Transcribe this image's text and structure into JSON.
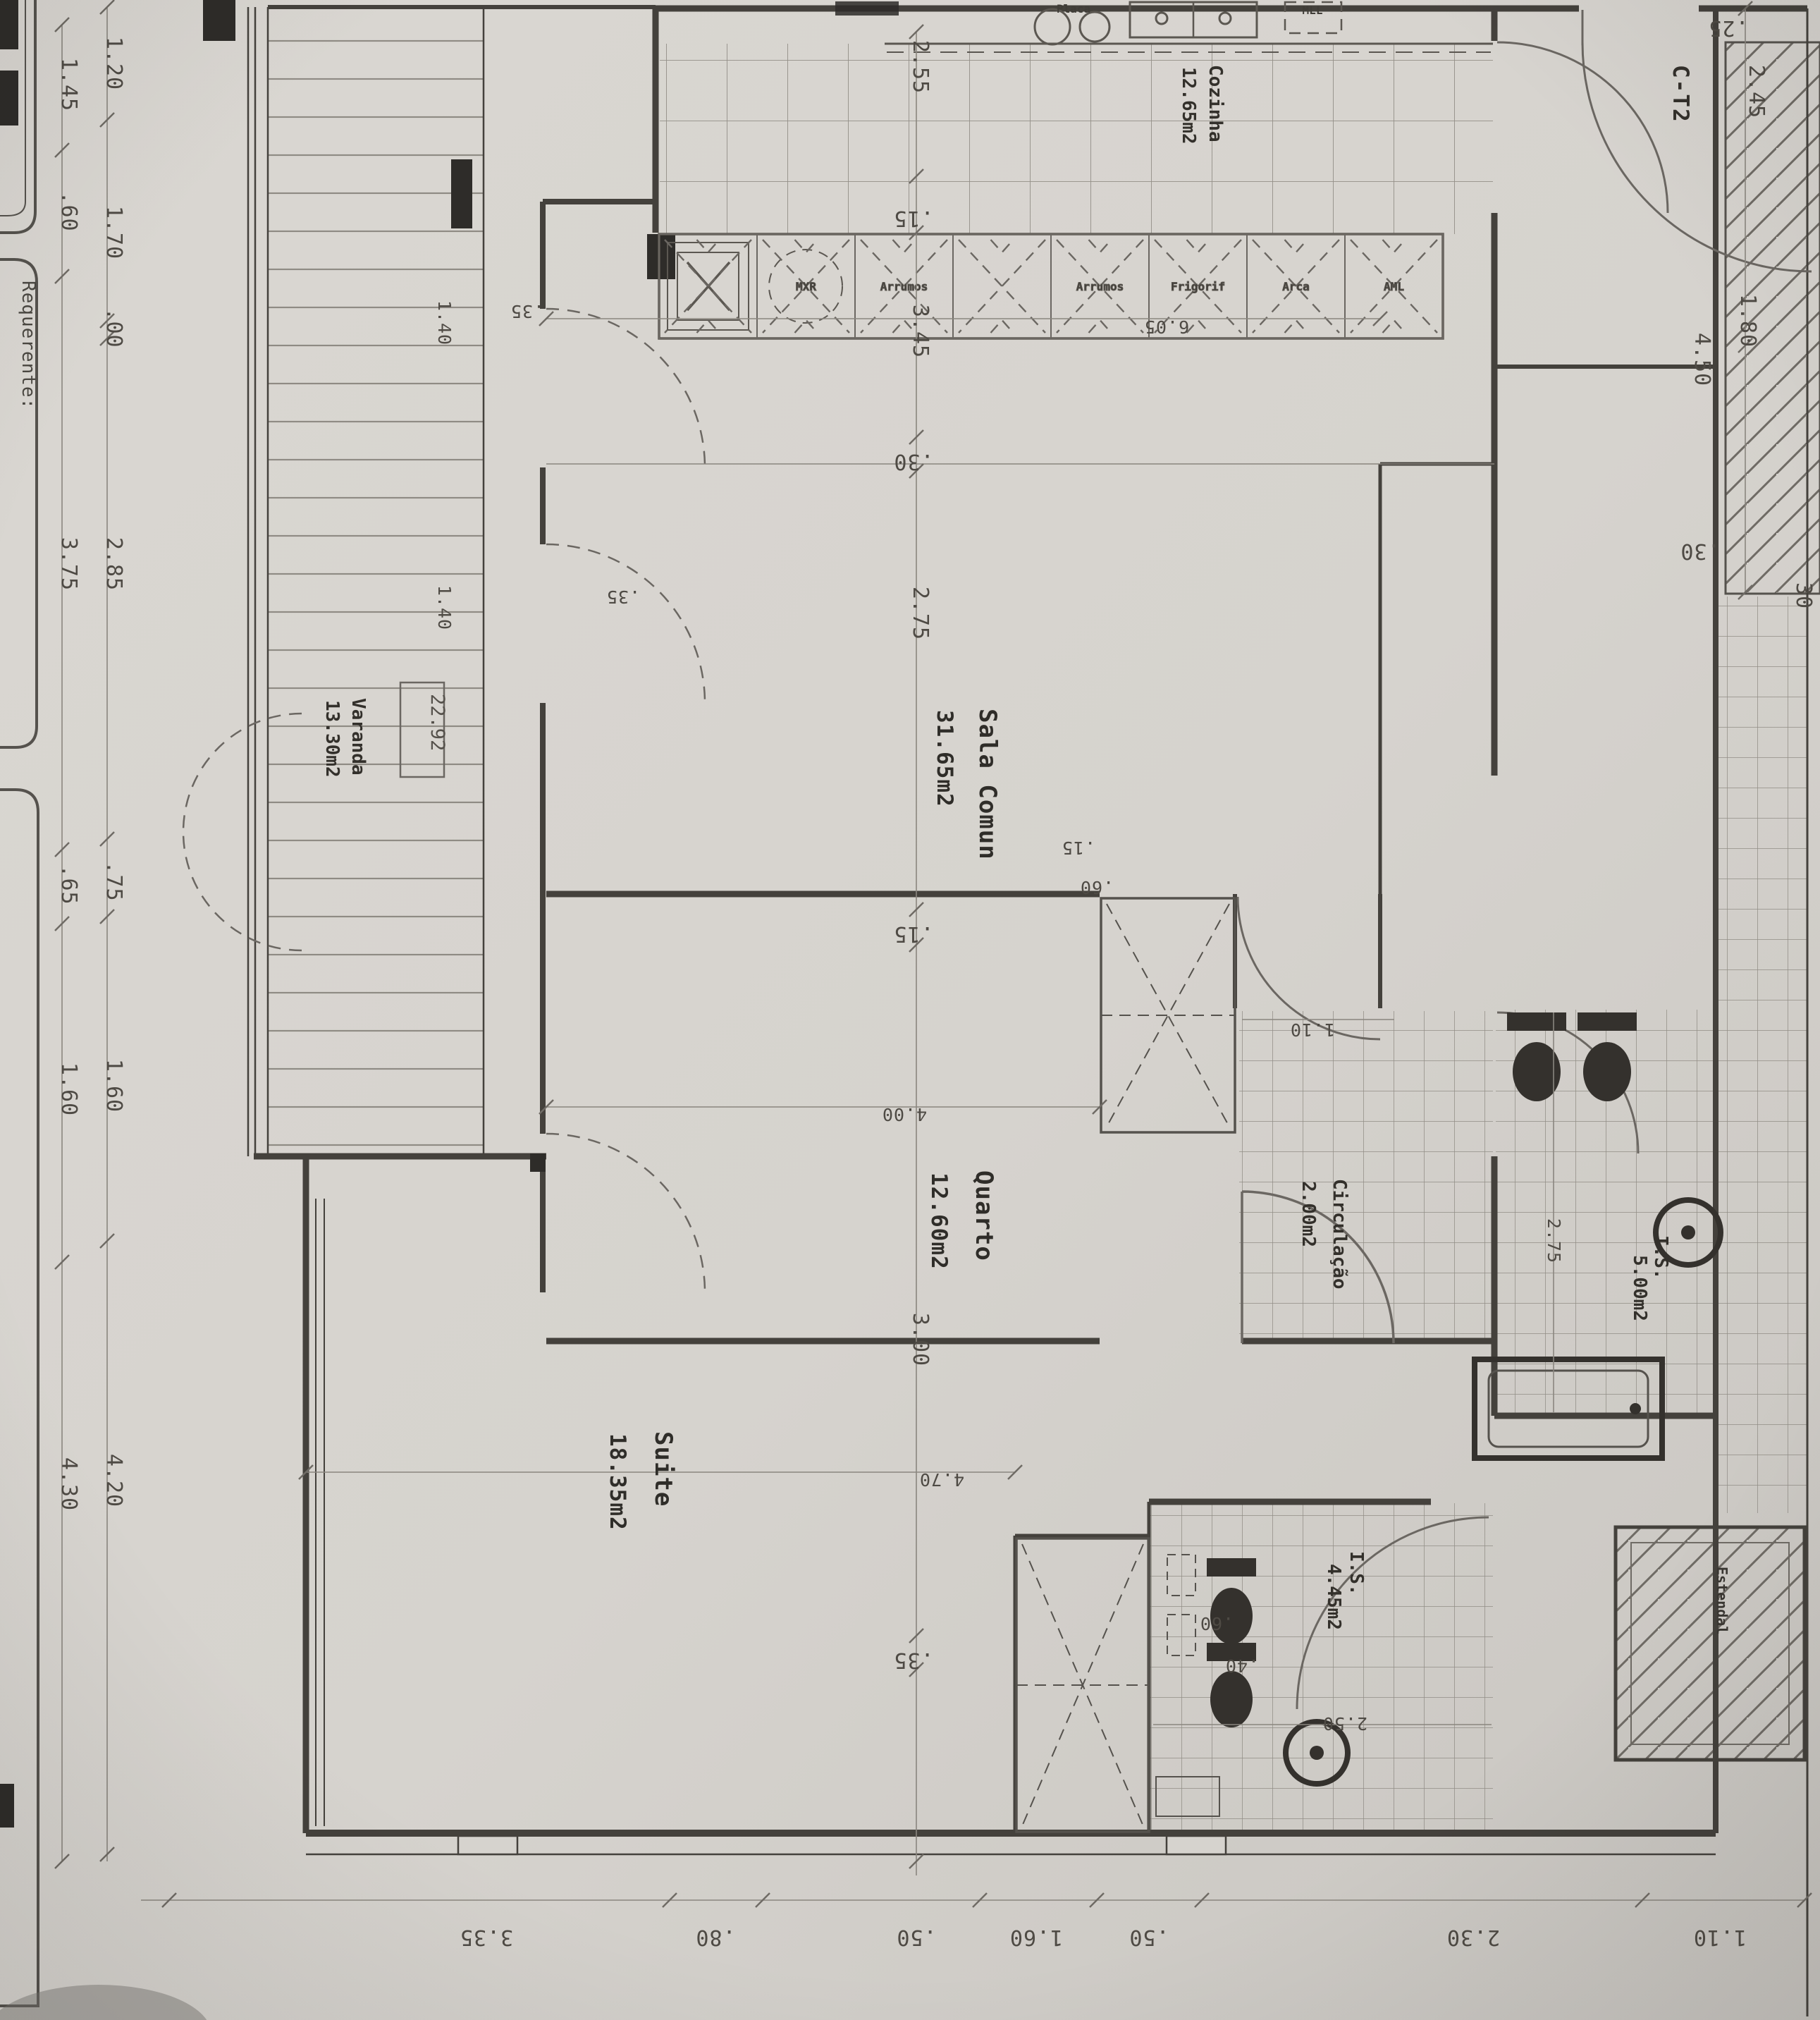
{
  "document": {
    "unit_label": "C-T2",
    "title_block_label": "Requerente:",
    "level_marker": "22.92"
  },
  "rooms": {
    "sala": {
      "name": "Sala Comun",
      "area": "31.65m2"
    },
    "quarto": {
      "name": "Quarto",
      "area": "12.60m2"
    },
    "suite": {
      "name": "Suite",
      "area": "18.35m2"
    },
    "circulacao": {
      "name": "Circulação",
      "area": "2.00m2"
    },
    "cozinha": {
      "name": "Cozinha",
      "area": "12.65m2"
    },
    "varanda": {
      "name": "Varanda",
      "area": "13.30m2"
    },
    "is1": {
      "name": "I.S.",
      "area": "5.00m2"
    },
    "is2": {
      "name": "I.S.",
      "area": "4.45m2"
    },
    "estendal": {
      "name": "Estendal"
    }
  },
  "kitchen": {
    "hob_label": "Placa",
    "dishwasher_label": "MLL",
    "counter_labels": [
      "",
      "MXR",
      "Arrumos",
      "",
      "Arrumos",
      "Frigorif",
      "Arca",
      "AML"
    ]
  },
  "dimensions": {
    "left_outer": [
      "1.45",
      ".60",
      "3.75",
      ".65",
      "1.60",
      "4.30"
    ],
    "left_inner": [
      "1.20",
      "1.70",
      ".00",
      "2.85",
      ".75",
      "1.60",
      "4.20"
    ],
    "bottom": [
      "3.35",
      ".80",
      ".50",
      "1.60",
      ".50",
      "2.30",
      "1.10"
    ],
    "center_chain": [
      "2.55",
      ".15",
      "3.45",
      ".30",
      "2.75",
      ".15",
      "3.00",
      ".35"
    ],
    "right_chain": [
      ".25",
      "2.45",
      "1.80",
      "4.50",
      ".30",
      "30"
    ],
    "interior": [
      "1.40",
      ".35",
      "1.40",
      ".35",
      "4.00",
      "6.05",
      "4.70",
      "1.10",
      "2.75",
      "2.50",
      ".15",
      ".60",
      ".60",
      ".40"
    ]
  },
  "colors": {
    "paper": "#d6d3ce",
    "wall": "#44413c",
    "thin_line": "#8a867f",
    "pencil_text": "#4e4a44"
  }
}
